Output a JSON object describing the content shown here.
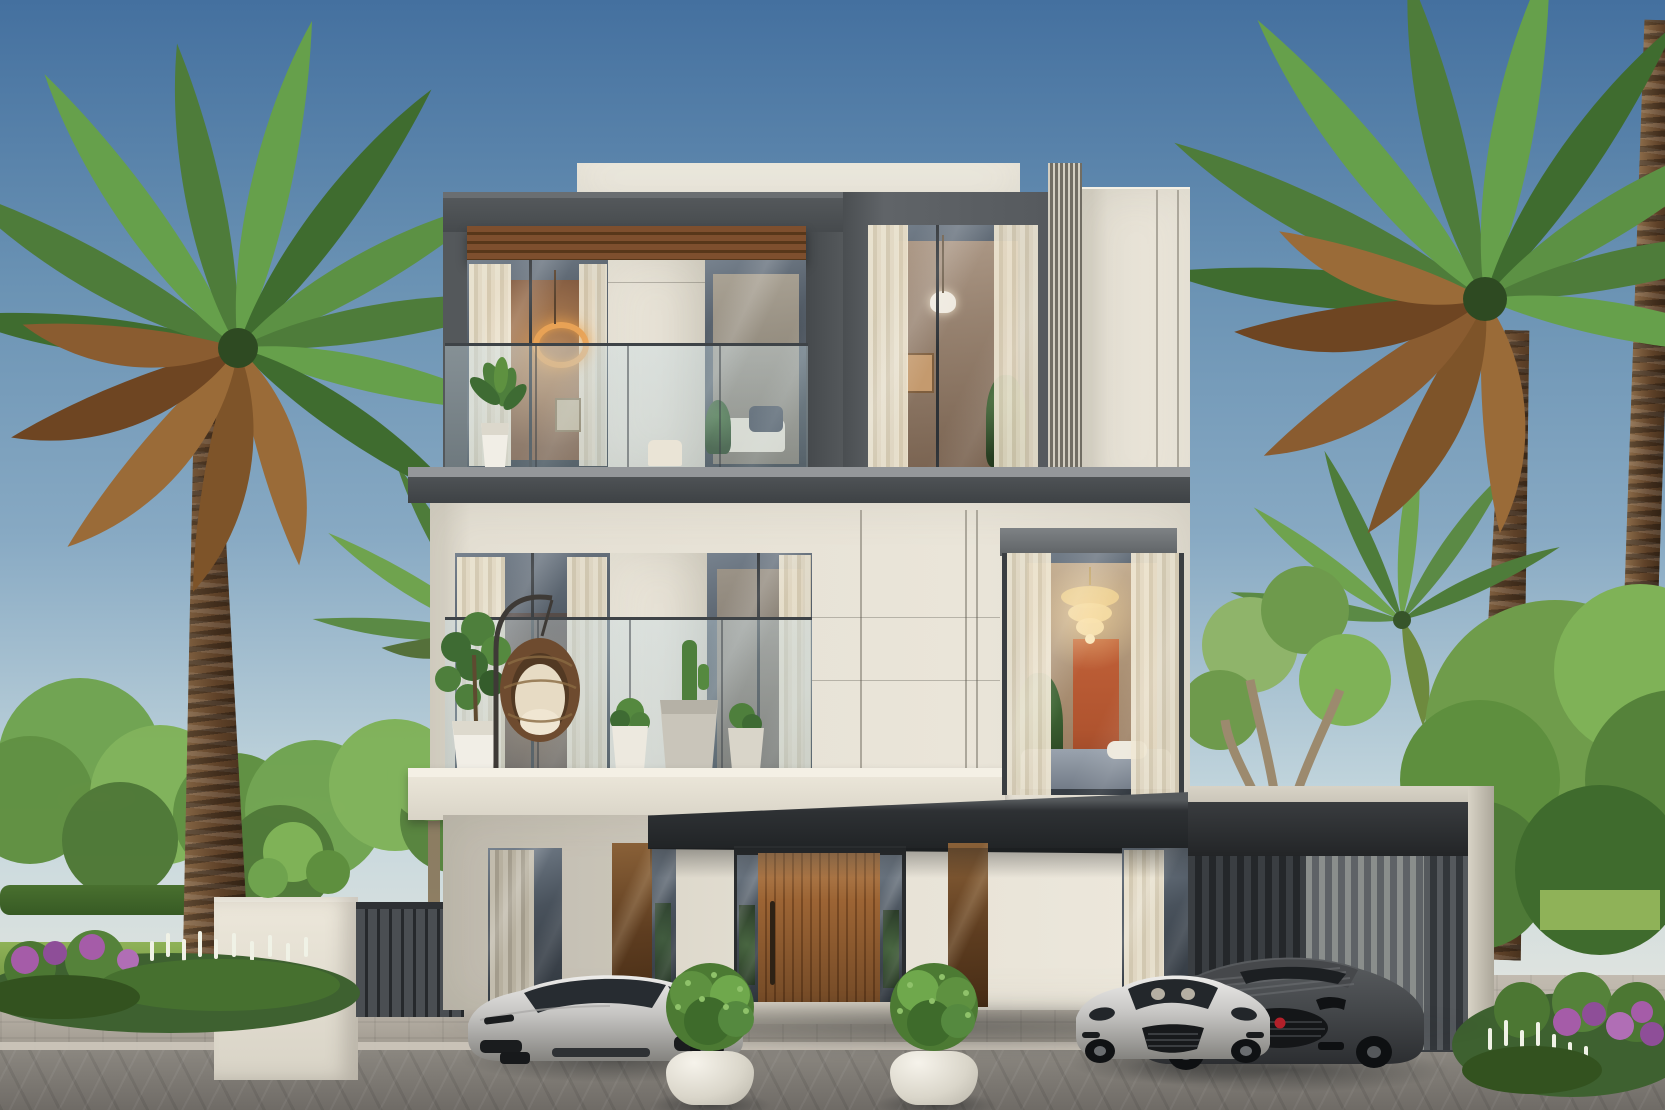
{
  "scene": {
    "type": "architectural-exterior-rendering",
    "description": "Front elevation of a three-storey modern luxury villa in daylight, flanked by tall palm trees, with three sports cars parked on a paved driveway and a slatted carport on the right.",
    "sky": {
      "clouds": 2,
      "gradient": "deep blue at top fading to pale warm haze at the horizon"
    },
    "colors": {
      "skyTop": "#44709F",
      "skyMid": "#87A9C3",
      "skyLow": "#C3D6DD",
      "haze": "#DEE3DF",
      "parapet": "#EFEBE0",
      "facade": "#E4DFD3",
      "facadeShade": "#D2CDC0",
      "joint": "#ACA79B",
      "frameDark": "#54585B",
      "panelDark": "#606468",
      "slabDark": "#4E5255",
      "pergola": "#7A4D2B",
      "doorWood": "#9C6434",
      "doorWoodDark": "#7A4A23",
      "bronze": "#7E5838",
      "glassHi": "#77828E",
      "glassMid": "#49525C",
      "glassLo": "#2F353C",
      "curtain": "#EFE7D3",
      "warmGlow": "#D89A5F",
      "terracotta": "#B0542F",
      "gold": "#E9CD92",
      "carportSlat": "#4A4E52",
      "fascia": "#CBC6BA",
      "paveTop": "#B9B2A7",
      "paveBot": "#9C968C",
      "street": "#8B8780",
      "streetDark": "#6F6B66",
      "curb": "#CDC7BB",
      "grass": "#82A84F",
      "treeBright": "#7FB257",
      "tree": "#5E8F3E",
      "treeDark": "#3F6B2D",
      "palm": "#4E7C3A",
      "palmDry": "#9A6B38",
      "trunk": "#76563A",
      "flowerPurple": "#A55CA8",
      "flowerWhite": "#F0F2E6",
      "silverCar": "#C6C5C3",
      "darkCar": "#4E5154",
      "badgeRed": "#B3202A",
      "wallWhite": "#ECE7DA",
      "fence": "#3C4043"
    },
    "building": {
      "label": "modern three-storey villa",
      "floors": 3,
      "top_floor": {
        "elements": [
          "cream parapet slab",
          "dark grey frame",
          "timber pergola soffit",
          "glass balcony with frameless railing",
          "potted plant",
          "ring pendant light",
          "recessed dark panel window with curtains",
          "vertical louver strip",
          "cream stone pier"
        ]
      },
      "middle_floor": {
        "elements": [
          "dark balcony slab",
          "glass walls with sheer curtains",
          "hanging rattan egg chair",
          "fiddle-leaf plant in white pot",
          "three potted cacti",
          "cream balcony slab",
          "large corner window with crystal chandelier",
          "terracotta interior wall",
          "bed with grey blanket"
        ]
      },
      "ground_floor": {
        "elements": [
          "vertical wood-slat entrance door",
          "two glass sidelights",
          "bronze glass panels",
          "dark entrance canopy",
          "curtained windows",
          "stone piers",
          "entry step"
        ]
      }
    },
    "carport": {
      "label": "slatted carport",
      "elements": [
        "dark roof slab",
        "light outer fascia frame",
        "vertical slat walls",
        "interior shadow"
      ]
    },
    "vehicles": [
      {
        "id": "silver-sports-coupe",
        "label": "silver sports coupe parked left of the entrance",
        "color": "#C6C5C3"
      },
      {
        "id": "silver-grand-tourer",
        "label": "silver grand tourer parked right of the entrance",
        "color": "#C6C5C3"
      },
      {
        "id": "dark-convertible",
        "label": "dark grey convertible with red grille badge parked in the carport",
        "color": "#4E5154"
      }
    ],
    "landscape": {
      "left": [
        "large date palm with dry lower fronds",
        "small coconut palm",
        "leafy green trees",
        "white boundary wall",
        "dark slatted gate fence",
        "flower bed with purple and white blossoms",
        "lawn strip"
      ],
      "right": [
        "large date palm with dry fronds",
        "tall bare palm trunk at image edge",
        "small coconut palm behind carport",
        "large leafy trees",
        "flower bed with magenta and white blossoms",
        "lawn strip"
      ],
      "foreground": [
        "light paver driveway",
        "darker paver street band",
        "two white round planters with topiary shrubs"
      ]
    }
  }
}
